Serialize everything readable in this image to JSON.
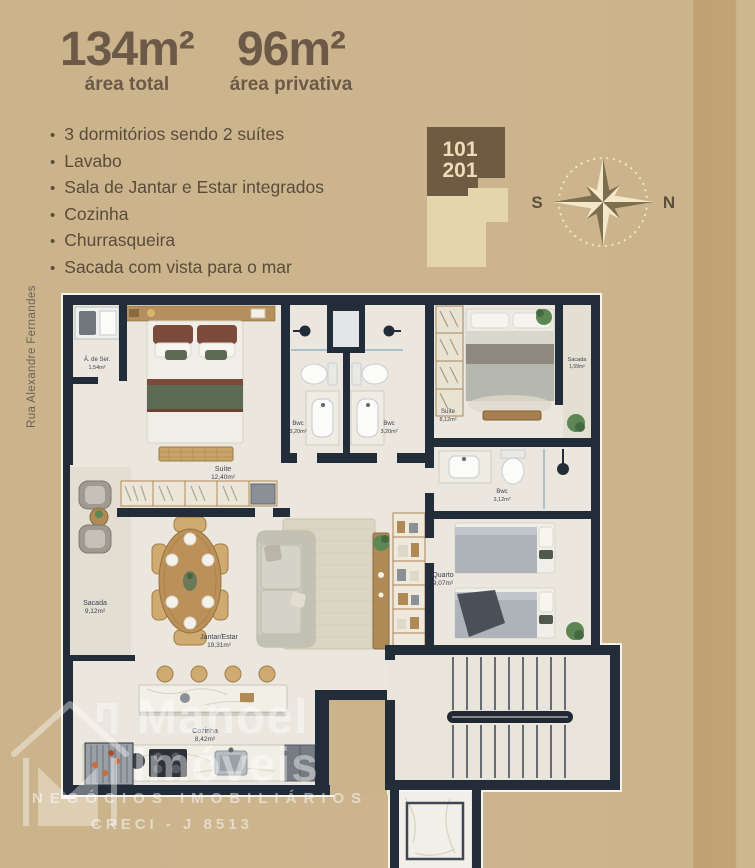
{
  "header": {
    "total_value": "134m²",
    "total_label": "área total",
    "private_value": "96m²",
    "private_label": "área privativa"
  },
  "features": [
    "3 dormitórios sendo 2 suítes",
    "Lavabo",
    "Sala de Jantar e Estar integrados",
    "Cozinha",
    "Churrasqueira",
    "Sacada com vista para o mar"
  ],
  "unit_badge": {
    "line1": "101",
    "line2": "201"
  },
  "compass": {
    "west": "S",
    "east": "N"
  },
  "street_label": "Rua Alexandre Fernandes",
  "rooms": {
    "area_servico": {
      "name": "Á. de Ser.",
      "area": "1,54m²"
    },
    "suite_master": {
      "name": "Suíte",
      "area": "12,40m²"
    },
    "bwc_1": {
      "name": "Bwc",
      "area": "3,20m²"
    },
    "bwc_2": {
      "name": "Bwc",
      "area": "3,20m²"
    },
    "suite_2": {
      "name": "Suíte",
      "area": "8,12m²"
    },
    "sacada_suite": {
      "name": "Sacada",
      "area": "1,59m²"
    },
    "bwc_3": {
      "name": "Bwc",
      "area": "3,12m²"
    },
    "quarto": {
      "name": "Quarto",
      "area": "9,07m²"
    },
    "sacada": {
      "name": "Sacada",
      "area": "9,12m²"
    },
    "jantar_estar": {
      "name": "Jantar/Estar",
      "area": "19,31m²"
    },
    "cozinha": {
      "name": "Cozinha",
      "area": "8,42m²"
    }
  },
  "watermark": {
    "brand_top": "Manoel",
    "brand_bottom": "Imóveis",
    "tagline": "NEGÓCIOS IMOBILIÁRIOS",
    "creci": "CRECI - J 8513"
  },
  "colors": {
    "background": "#cbb48c",
    "background_band": "#c1a274",
    "text_brown": "#5a4b3a",
    "header_brown": "#6c5947",
    "badge_dark": "#6f5b42",
    "badge_light": "#e4d5ac",
    "wall": "#232d3a",
    "floor": "#ebe7de",
    "balcony_floor": "#e2ded2"
  }
}
